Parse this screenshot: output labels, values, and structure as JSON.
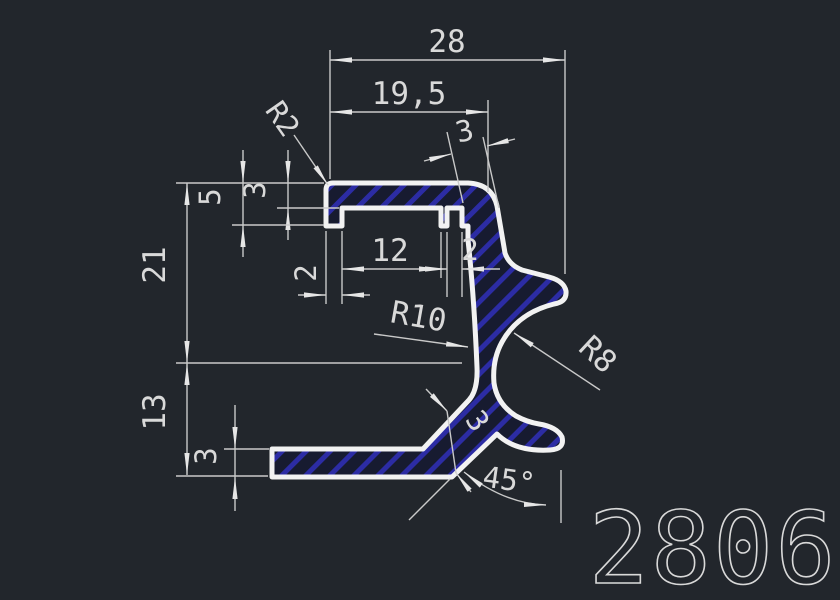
{
  "drawing": {
    "part_number": "2806",
    "labels": {
      "overall_width": "28",
      "top_width": "19,5",
      "right_wall_thickness": "3",
      "corner_radius": "R2",
      "top_bar_thickness": "3",
      "groove_depth": "5",
      "upper_height": "21",
      "lower_height": "13",
      "base_thickness": "3",
      "left_leg_width": "2",
      "inner_width": "12",
      "slot_width": "2",
      "inner_radius": "R10",
      "hook_radius": "R8",
      "strut_thickness": "3",
      "chamfer_angle": "45°"
    },
    "colors": {
      "background": "#22262c",
      "outline": "#f2f2f2",
      "dimension_lines": "#c9c9c9",
      "text": "#d9d9d9",
      "hatch_fill": "#171b30",
      "hatch_line": "#2c2ca4"
    }
  }
}
